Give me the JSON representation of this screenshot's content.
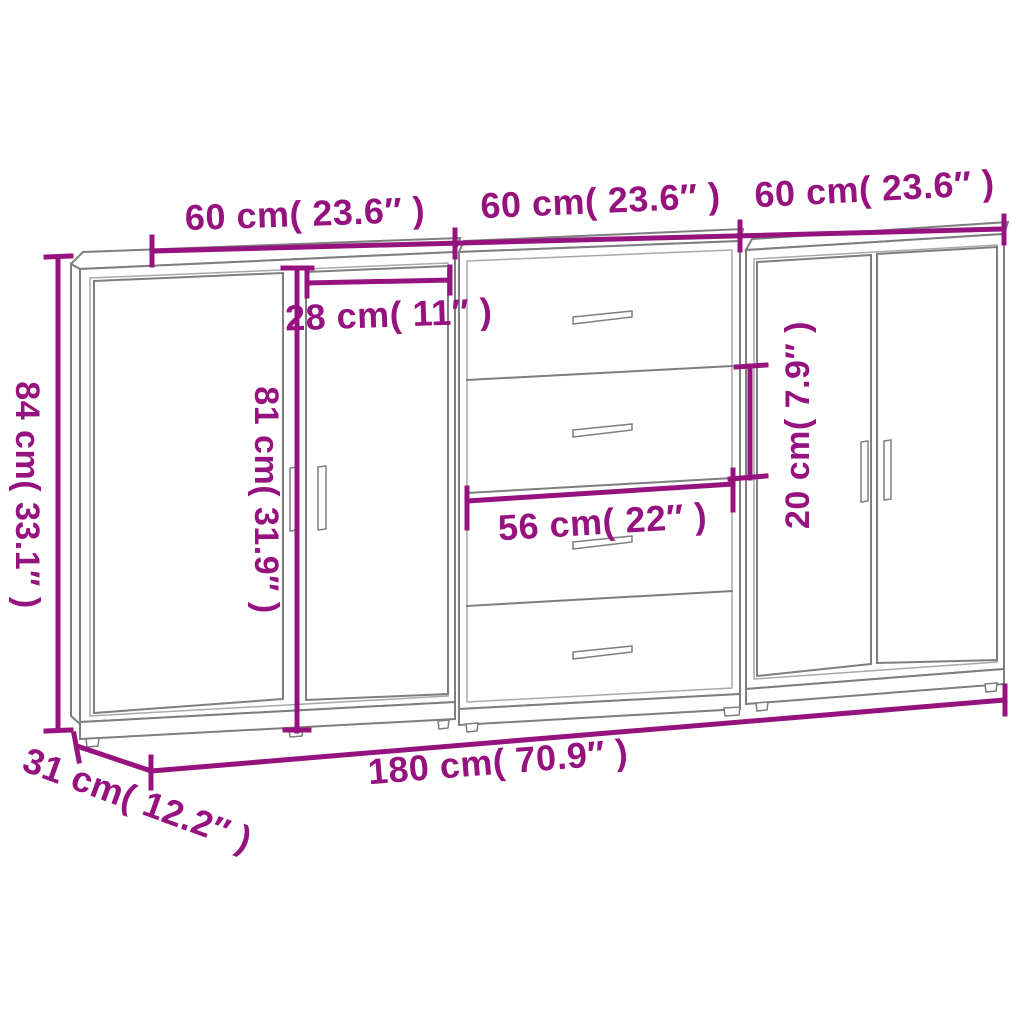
{
  "diagram": {
    "colors": {
      "dimension_accent": "#96137f",
      "outline_gray": "#7e7e7e",
      "background": "#ffffff"
    },
    "dimensions": {
      "unit_width_1": "60 cm( 23.6″ )",
      "unit_width_2": "60 cm( 23.6″ )",
      "unit_width_3": "60 cm( 23.6″ )",
      "overall_height": "84 cm( 33.1″ )",
      "door_width": "28 cm( 11″ )",
      "door_height": "81 cm( 31.9″ )",
      "drawer_width": "56 cm( 22″ )",
      "drawer_height": "20 cm( 7.9″ )",
      "overall_width": "180 cm( 70.9″ )",
      "overall_depth": "31 cm( 12.2″ )"
    }
  }
}
